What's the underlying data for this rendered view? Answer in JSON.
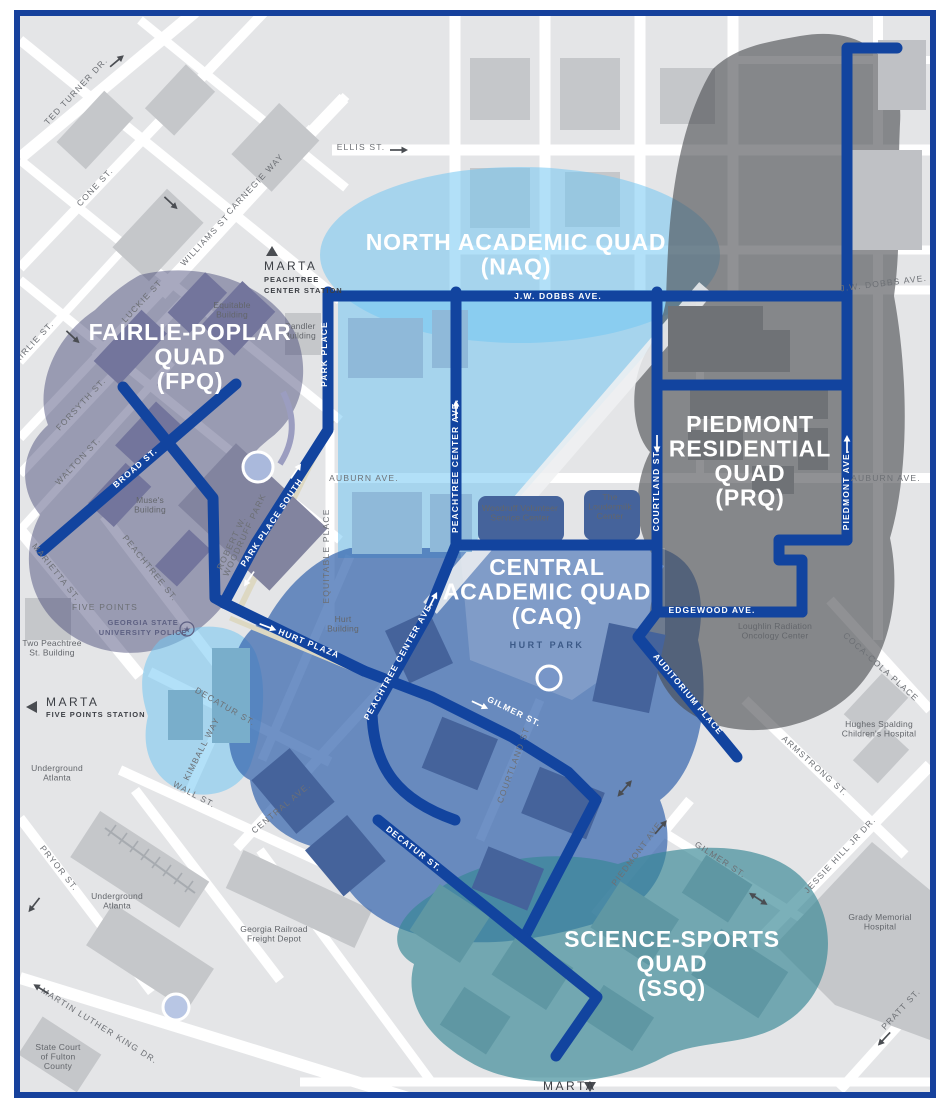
{
  "map_title": "Georgia State University campus quads map",
  "colors": {
    "frame": "#16419c",
    "base_bg": "#e4e5e7",
    "street": "#ffffff",
    "route": "#12449f",
    "building_base": "#c5c7ca",
    "fpq_fill": "rgba(62,64,112,0.45)",
    "naq_fill": "rgba(114,198,242,0.55)",
    "caq_fill": "rgba(55,103,175,0.72)",
    "prq_fill": "rgba(70,72,77,0.60)",
    "ssq_fill": "rgba(55,135,148,0.66)"
  },
  "quads": [
    {
      "id": "fpq",
      "lines": [
        "FAIRLIE-POPLAR",
        "QUAD",
        "(FPQ)"
      ],
      "x": 190,
      "y": 340,
      "sub": null
    },
    {
      "id": "naq",
      "lines": [
        "NORTH ACADEMIC QUAD",
        "(NAQ)"
      ],
      "x": 516,
      "y": 250,
      "sub": null
    },
    {
      "id": "caq",
      "lines": [
        "CENTRAL",
        "ACADEMIC QUAD",
        "(CAQ)"
      ],
      "x": 547,
      "y": 575,
      "sub": "HURT PARK",
      "subx": 547,
      "suby": 648
    },
    {
      "id": "prq",
      "lines": [
        "PIEDMONT",
        "RESIDENTIAL",
        "QUAD",
        "(PRQ)"
      ],
      "x": 750,
      "y": 432,
      "sub": null
    },
    {
      "id": "ssq",
      "lines": [
        "SCIENCE-SPORTS",
        "QUAD",
        "(SSQ)"
      ],
      "x": 672,
      "y": 947,
      "sub": null
    }
  ],
  "route_labels": [
    {
      "text": "PARK PLACE",
      "x": 327,
      "y": 354,
      "rot": -90
    },
    {
      "text": "J.W. DOBBS AVE.",
      "x": 558,
      "y": 299,
      "rot": 0
    },
    {
      "text": "PEACHTREE CENTER AVE.",
      "x": 458,
      "y": 466,
      "rot": -90
    },
    {
      "text": "COURTLAND ST.",
      "x": 659,
      "y": 490,
      "rot": -90
    },
    {
      "text": "PIEDMONT AVE.",
      "x": 849,
      "y": 490,
      "rot": -90
    },
    {
      "text": "PARK PLACE SOUTH",
      "x": 274,
      "y": 524,
      "rot": -56
    },
    {
      "text": "BROAD ST.",
      "x": 137,
      "y": 470,
      "rot": -41
    },
    {
      "text": "HURT PLAZA",
      "x": 308,
      "y": 646,
      "rot": 22
    },
    {
      "text": "PEACHTREE CENTER AVE.",
      "x": 401,
      "y": 662,
      "rot": -61
    },
    {
      "text": "GILMER ST.",
      "x": 513,
      "y": 714,
      "rot": 26
    },
    {
      "text": "EDGEWOOD AVE.",
      "x": 712,
      "y": 613,
      "rot": 0
    },
    {
      "text": "AUDITORIUM PLACE",
      "x": 686,
      "y": 696,
      "rot": 50
    },
    {
      "text": "DECATUR ST.",
      "x": 412,
      "y": 851,
      "rot": 38
    }
  ],
  "street_labels": [
    {
      "text": "TED TURNER DR.",
      "x": 78,
      "y": 93,
      "rot": -47
    },
    {
      "text": "CONE ST.",
      "x": 97,
      "y": 189,
      "rot": -47
    },
    {
      "text": "CARNEGIE WAY",
      "x": 257,
      "y": 186,
      "rot": -47
    },
    {
      "text": "WILLIAMS ST",
      "x": 207,
      "y": 242,
      "rot": -47
    },
    {
      "text": "ELLIS ST.",
      "x": 361,
      "y": 150,
      "rot": 0
    },
    {
      "text": "FAIRLIE ST.",
      "x": 34,
      "y": 346,
      "rot": -47
    },
    {
      "text": "LUCKIE ST",
      "x": 144,
      "y": 303,
      "rot": -47
    },
    {
      "text": "FORSYTH ST.",
      "x": 83,
      "y": 406,
      "rot": -47
    },
    {
      "text": "WALTON ST.",
      "x": 80,
      "y": 463,
      "rot": -47
    },
    {
      "text": "MARIETTA ST.",
      "x": 54,
      "y": 574,
      "rot": 51
    },
    {
      "text": "PEACHTREE ST.",
      "x": 148,
      "y": 570,
      "rot": 51
    },
    {
      "text": "FIVE POINTS",
      "x": 105,
      "y": 610,
      "rot": 0
    },
    {
      "text": "DECATUR ST.",
      "x": 224,
      "y": 709,
      "rot": 30
    },
    {
      "text": "KIMBALL WAY",
      "x": 204,
      "y": 750,
      "rot": -63
    },
    {
      "text": "WALL ST.",
      "x": 193,
      "y": 797,
      "rot": 28
    },
    {
      "text": "CENTRAL AVE.",
      "x": 283,
      "y": 810,
      "rot": -40
    },
    {
      "text": "PRYOR ST.",
      "x": 57,
      "y": 870,
      "rot": 51
    },
    {
      "text": "MARTIN LUTHER KING DR.",
      "x": 98,
      "y": 1028,
      "rot": 32
    },
    {
      "text": "AUBURN AVE.",
      "x": 364,
      "y": 481,
      "rot": 0
    },
    {
      "text": "EQUITABLE PLACE",
      "x": 329,
      "y": 556,
      "rot": -90
    },
    {
      "text": "AUBURN AVE.",
      "x": 886,
      "y": 481,
      "rot": 0
    },
    {
      "text": "J.W. DOBBS AVE.",
      "x": 884,
      "y": 286,
      "rot": -7
    },
    {
      "text": "COCA-COLA PLACE",
      "x": 879,
      "y": 669,
      "rot": 42
    },
    {
      "text": "ARMSTRONG ST.",
      "x": 813,
      "y": 768,
      "rot": 42
    },
    {
      "text": "JESSIE HILL JR DR.",
      "x": 842,
      "y": 857,
      "rot": -47
    },
    {
      "text": "PRATT ST.",
      "x": 903,
      "y": 1011,
      "rot": -47
    },
    {
      "text": "GILMER ST.",
      "x": 719,
      "y": 862,
      "rot": 33
    },
    {
      "text": "PIEDMONT AVE.",
      "x": 640,
      "y": 854,
      "rot": -53
    },
    {
      "text": "COURTLAND ST",
      "x": 516,
      "y": 766,
      "rot": -70
    },
    {
      "text": "ROBERT W.",
      "x": 234,
      "y": 544,
      "rot": -65
    },
    {
      "text": "WOODRUFF PARK",
      "x": 247,
      "y": 536,
      "rot": -65
    }
  ],
  "place_labels": [
    {
      "lines": [
        "Equitable",
        "Building"
      ],
      "x": 232,
      "y": 308
    },
    {
      "lines": [
        "Candler",
        "Building"
      ],
      "x": 300,
      "y": 329
    },
    {
      "lines": [
        "Muse's",
        "Building"
      ],
      "x": 150,
      "y": 503
    },
    {
      "lines": [
        "Two Peachtree",
        "St. Building"
      ],
      "x": 52,
      "y": 646
    },
    {
      "lines": [
        "Underground",
        "Atlanta"
      ],
      "x": 57,
      "y": 771
    },
    {
      "lines": [
        "Underground",
        "Atlanta"
      ],
      "x": 117,
      "y": 899
    },
    {
      "lines": [
        "Hurt",
        "Building"
      ],
      "x": 343,
      "y": 622
    },
    {
      "lines": [
        "Woodruff Volunteer",
        "Service Center"
      ],
      "x": 520,
      "y": 511
    },
    {
      "lines": [
        "The",
        "Loudermilk",
        "Center"
      ],
      "x": 610,
      "y": 500
    },
    {
      "lines": [
        "Georgia Railroad",
        "Freight Depot"
      ],
      "x": 274,
      "y": 932
    },
    {
      "lines": [
        "State Court",
        "of Fulton",
        "County"
      ],
      "x": 58,
      "y": 1050
    },
    {
      "lines": [
        "Loughlin Radiation",
        "Oncology Center"
      ],
      "x": 775,
      "y": 629
    },
    {
      "lines": [
        "Hughes Spalding",
        "Children's Hospital"
      ],
      "x": 879,
      "y": 727
    },
    {
      "lines": [
        "Grady Memorial",
        "Hospital"
      ],
      "x": 880,
      "y": 920
    }
  ],
  "police": {
    "lines": [
      "GEORGIA STATE",
      "UNIVERSITY POLICE"
    ],
    "x": 143,
    "y": 625,
    "star_x": 187,
    "star_y": 629
  },
  "marta": [
    {
      "dir": "up",
      "tri_x": 272,
      "tri_y": 252,
      "label": "MARTA",
      "lx": 264,
      "ly": 270,
      "station": [
        "PEACHTREE",
        "CENTER STATION"
      ],
      "sx": 264,
      "sy": 282
    },
    {
      "dir": "left",
      "tri_x": 33,
      "tri_y": 707,
      "label": "MARTA",
      "lx": 46,
      "ly": 706,
      "station": [
        "FIVE POINTS STATION"
      ],
      "sx": 46,
      "sy": 717
    },
    {
      "dir": "down",
      "tri_x": 590,
      "tri_y": 1086,
      "label": "MARTA",
      "lx": 543,
      "ly": 1090,
      "station": [],
      "sx": 0,
      "sy": 0
    }
  ],
  "arrows": [
    {
      "x": 117,
      "y": 61,
      "rot": -40,
      "c": "#4a4d52",
      "double": false
    },
    {
      "x": 171,
      "y": 203,
      "rot": 43,
      "c": "#4a4d52",
      "double": false
    },
    {
      "x": 399,
      "y": 150,
      "rot": 0,
      "c": "#4a4d52",
      "double": false
    },
    {
      "x": 73,
      "y": 337,
      "rot": 43,
      "c": "#4a4d52",
      "double": false
    },
    {
      "x": 34,
      "y": 905,
      "rot": 128,
      "c": "#4a4d52",
      "double": false
    },
    {
      "x": 41,
      "y": 989,
      "rot": 212,
      "c": "#4a4d52",
      "double": false
    },
    {
      "x": 884,
      "y": 1039,
      "rot": 133,
      "c": "#4a4d52",
      "double": false
    },
    {
      "x": 661,
      "y": 827,
      "rot": -49,
      "c": "#4a4d52",
      "double": false
    },
    {
      "x": 760,
      "y": 900,
      "rot": 33,
      "c": "#4a4d52",
      "double": true
    },
    {
      "x": 626,
      "y": 787,
      "rot": -49,
      "c": "#4a4d52",
      "double": true
    },
    {
      "x": 296,
      "y": 471,
      "rot": -56,
      "c": "#ffffff",
      "double": false
    },
    {
      "x": 249,
      "y": 579,
      "rot": 124,
      "c": "#ffffff",
      "double": false
    },
    {
      "x": 268,
      "y": 627,
      "rot": 21,
      "c": "#ffffff",
      "double": false
    },
    {
      "x": 456,
      "y": 409,
      "rot": -90,
      "c": "#ffffff",
      "double": false
    },
    {
      "x": 433,
      "y": 600,
      "rot": -63,
      "c": "#ffffff",
      "double": false
    },
    {
      "x": 480,
      "y": 705,
      "rot": 25,
      "c": "#ffffff",
      "double": false
    },
    {
      "x": 657,
      "y": 444,
      "rot": 90,
      "c": "#ffffff",
      "double": false
    },
    {
      "x": 847,
      "y": 444,
      "rot": -90,
      "c": "#ffffff",
      "double": false
    }
  ]
}
